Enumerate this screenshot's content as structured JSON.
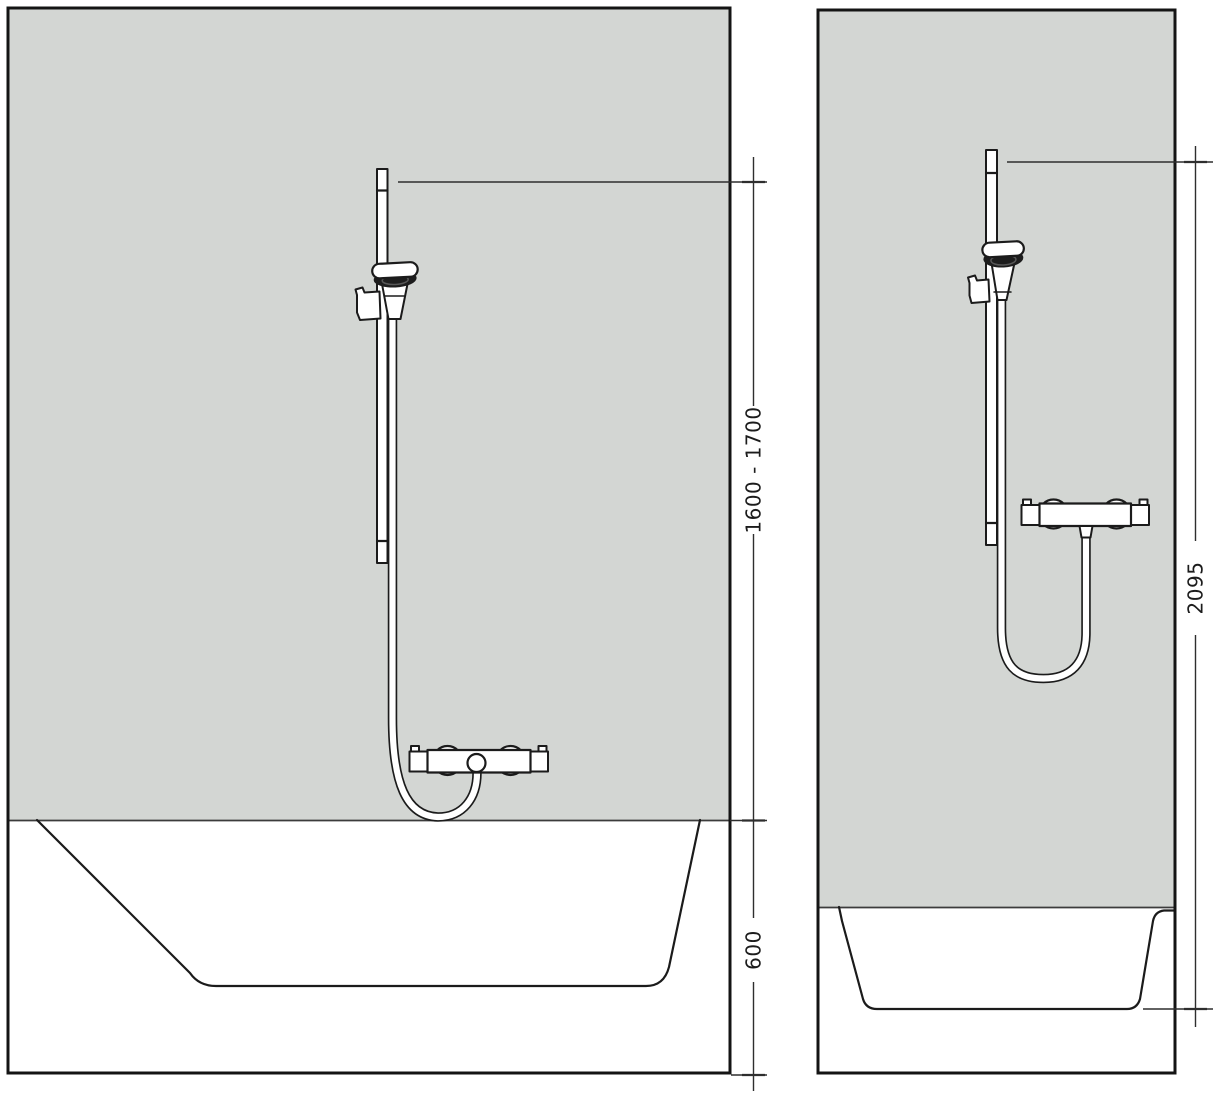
{
  "colors": {
    "background": "#ffffff",
    "wall": "#d3d6d3",
    "line": "#1b1b1b",
    "spray_face": "#1d1d1d"
  },
  "front_view": {
    "dim_bar_range": "1600 - 1700",
    "dim_tub_height": "600"
  },
  "side_view": {
    "dim_total_height": "2095"
  }
}
